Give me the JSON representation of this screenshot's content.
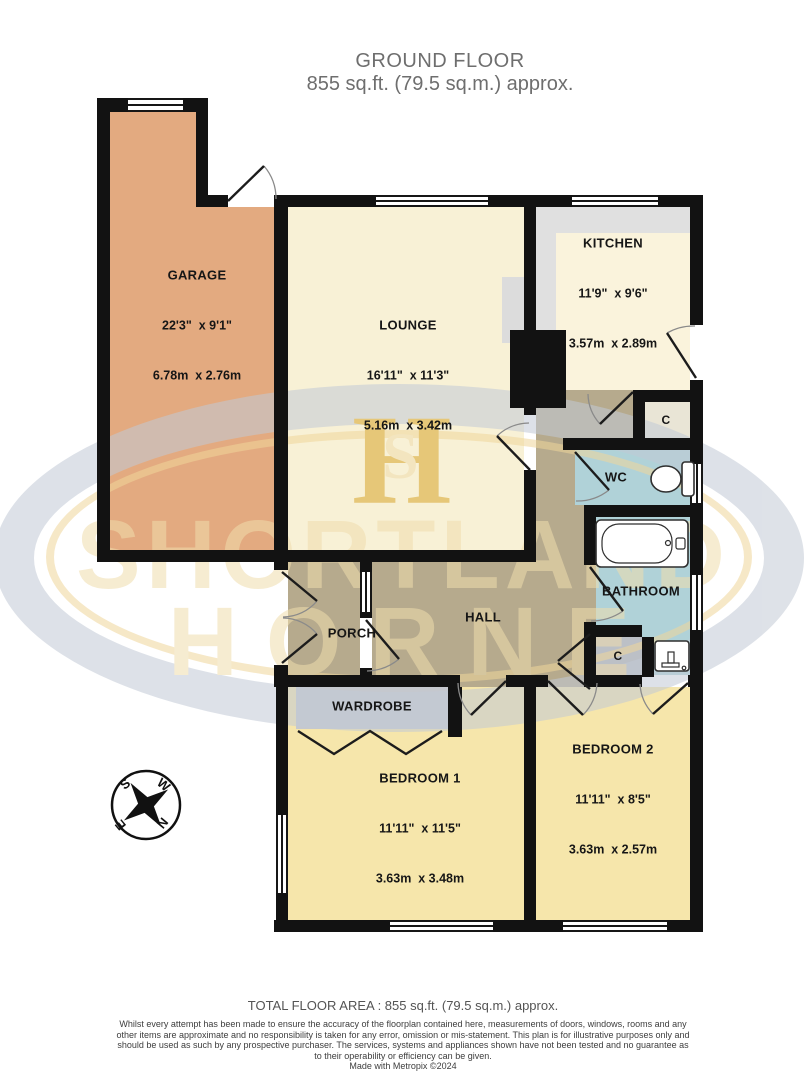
{
  "header": {
    "title": "GROUND FLOOR",
    "subtitle": "855 sq.ft. (79.5 sq.m.) approx."
  },
  "watermark": {
    "brand_line1": "SHORTLAND",
    "brand_line2": "HORNE",
    "monogram_h": "H",
    "monogram_s": "S"
  },
  "rooms": {
    "garage": {
      "name": "GARAGE",
      "imperial": "22'3\"  x 9'1\"",
      "metric": "6.78m  x 2.76m"
    },
    "lounge": {
      "name": "LOUNGE",
      "imperial": "16'11\"  x 11'3\"",
      "metric": "5.16m  x 3.42m"
    },
    "kitchen": {
      "name": "KITCHEN",
      "imperial": "11'9\"  x 9'6\"",
      "metric": "3.57m  x 2.89m"
    },
    "bedroom1": {
      "name": "BEDROOM 1",
      "imperial": "11'11\"  x 11'5\"",
      "metric": "3.63m  x 3.48m"
    },
    "bedroom2": {
      "name": "BEDROOM 2",
      "imperial": "11'11\"  x 8'5\"",
      "metric": "3.63m  x 2.57m"
    },
    "wc": {
      "name": "WC"
    },
    "bathroom": {
      "name": "BATHROOM"
    },
    "hall": {
      "name": "HALL"
    },
    "porch": {
      "name": "PORCH"
    },
    "wardrobe": {
      "name": "WARDROBE"
    },
    "cupboard_top": {
      "name": "C"
    },
    "cupboard_bottom": {
      "name": "C"
    }
  },
  "compass": {
    "north": "N",
    "south": "S",
    "east": "E",
    "west": "W"
  },
  "icons": {
    "toilet": "toilet-icon",
    "bathtub": "bathtub-icon",
    "sink": "sink-icon",
    "compass": "compass-rose"
  },
  "footer": {
    "total_area": "TOTAL FLOOR AREA : 855 sq.ft. (79.5 sq.m.) approx.",
    "disclaimer": "Whilst every attempt has been made to ensure the accuracy of the floorplan contained here, measurements of doors, windows, rooms and any other items are approximate and no responsibility is taken for any error, omission or mis-statement. This plan is for illustrative purposes only and should be used as such by any prospective purchaser. The services, systems and appliances shown have not been tested and no guarantee as to their operability or efficiency can be given.",
    "credit": "Made with Metropix ©2024"
  },
  "colors": {
    "wall": "#121212",
    "garage": "#e3aa80",
    "lounge": "#f8f1d6",
    "kitchen": "#faf3dc",
    "bedroom": "#f6e6ab",
    "hall": "#b6aa8d",
    "bathroom": "#b0d2d8",
    "cupboard": "#bcc0c6",
    "cupboard_cream": "#e9e5d6",
    "counter": "#e0e0e0",
    "wardrobe": "#c5c8ce",
    "recess": "#dcdcdc",
    "watermark_ring": "#c2cad6",
    "watermark_gold": "#f0d69b",
    "watermark_text": "#f0ddad",
    "monogram_gold": "#d8a52c"
  }
}
